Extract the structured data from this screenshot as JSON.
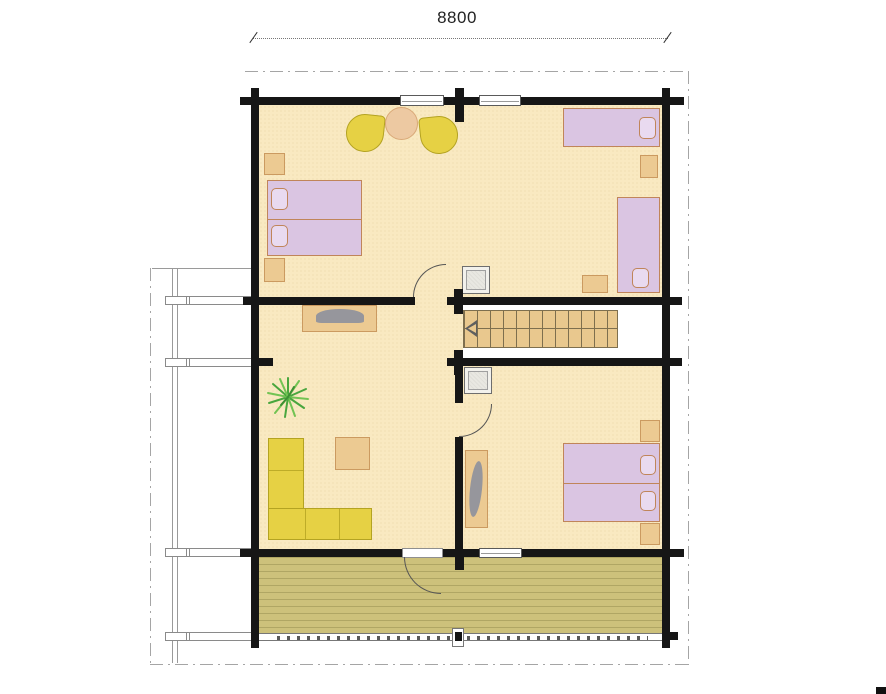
{
  "dimension": {
    "width_label": "8800"
  },
  "colors": {
    "wall": "#161616",
    "floor": "#f9e9c1",
    "corridor": "#ffffff",
    "deck": "#cdc17b",
    "bed": "#dac5e2",
    "bed_border": "#c0855a",
    "pillow": "#e9daf0",
    "wood": "#ecca92",
    "wood_border": "#cb9a60",
    "yellow": "#e6d144",
    "yellow_border": "#b4a322",
    "stairs": "#e9c88e",
    "stair_line": "#7e6f4e",
    "gray_object": "#96969c",
    "plant_green": "#49a63e",
    "plant_green_light": "#72c353",
    "dash": "#a5a5a5",
    "dim_text": "#222222"
  },
  "plan": {
    "type": "log-house floor plan, single storey with terrace",
    "rooms": [
      {
        "name": "bedroom-top",
        "furniture": [
          "double-bed",
          "pillow",
          "pillow",
          "nightstand",
          "nightstand",
          "armchair",
          "armchair",
          "round-table",
          "single-bed",
          "single-bed",
          "pillow",
          "pillow",
          "nightstand",
          "wardrobe-row-4",
          "nightstand"
        ]
      },
      {
        "name": "living-room",
        "furniture": [
          "tv-table",
          "plant",
          "corner-sofa",
          "coffee-table"
        ]
      },
      {
        "name": "stair-hall",
        "furniture": [
          "staircase",
          "stair-direction-arrow"
        ]
      },
      {
        "name": "bedroom-bottom",
        "furniture": [
          "wardrobe-row-4",
          "dresser",
          "double-bed",
          "pillow",
          "pillow",
          "nightstand",
          "nightstand"
        ]
      },
      {
        "name": "terrace",
        "furniture": [
          "railing",
          "railing-post"
        ]
      }
    ],
    "openings": [
      "window-top-left",
      "window-top-right",
      "window-bottom",
      "exterior-door-to-terrace",
      "door-bedroom-top",
      "door-bedroom-bottom"
    ]
  }
}
